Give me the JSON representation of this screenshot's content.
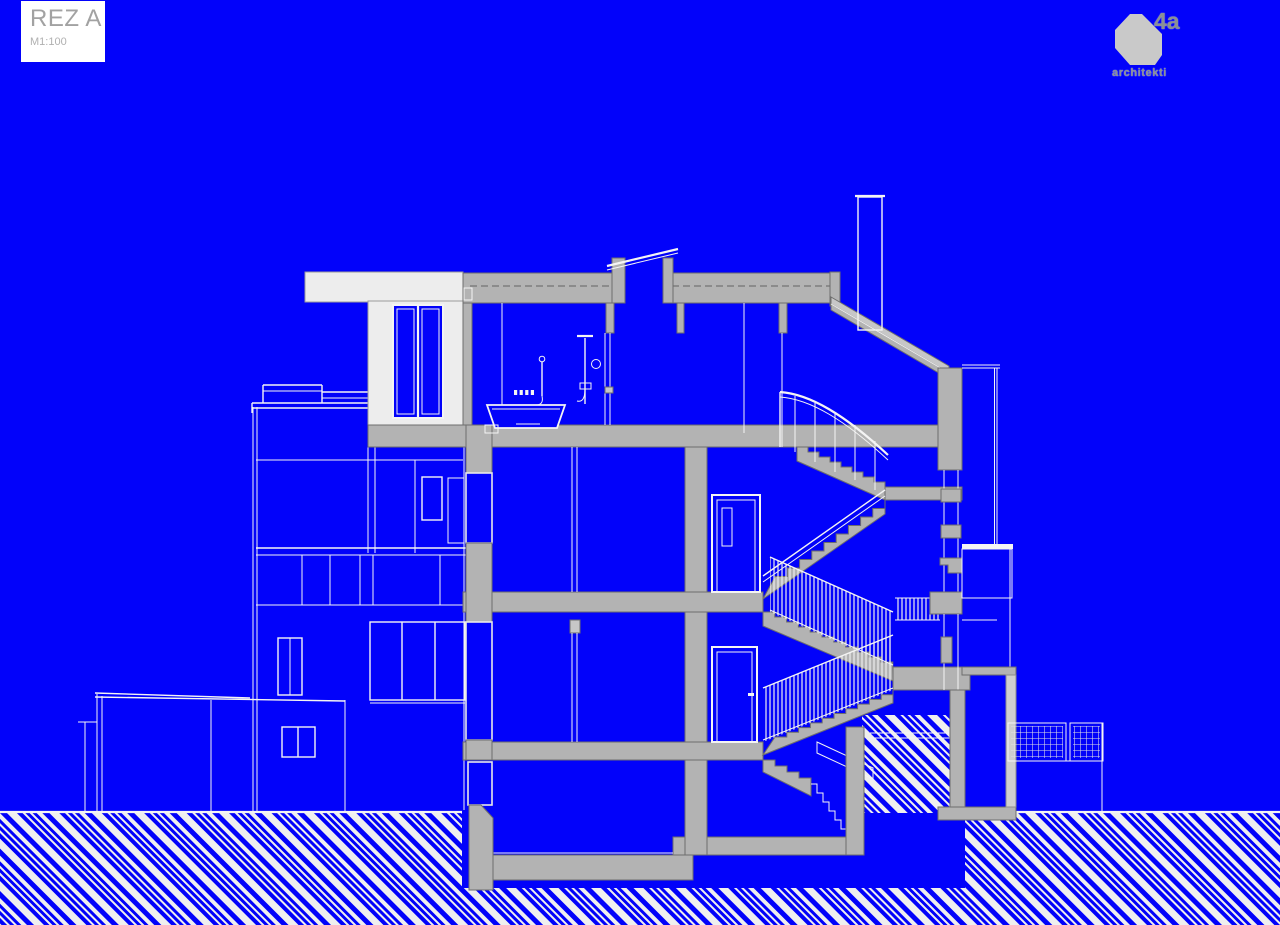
{
  "title_block": {
    "title": "REZ A",
    "scale": "M1:100"
  },
  "logo": {
    "mark": "4a",
    "name": "architekti"
  },
  "palette": {
    "background": "#0202fa",
    "cut_fill": "#b3b3b3",
    "cut_outline": "#6e6e6e",
    "line_white": "#f4f4f4",
    "elevation_white": "#ededed",
    "elevation_outline": "#9c9c9c",
    "title_bg": "#ffffff",
    "title_text": "#a2a2a2",
    "scale_text": "#b0b0b0",
    "logo_shape": "#c9c9c9",
    "logo_text": "#8a9094"
  },
  "drawing": {
    "kind": "building cross-section",
    "visible_elements": [
      "flat-roof-with-skylight",
      "chimney",
      "penthouse-volume",
      "terrace-railing",
      "bathroom-with-bathtub-and-showers",
      "four-storey-switchback-staircase",
      "hatched-stair-balustrades",
      "interior-doors",
      "left-facade-windows",
      "garden-annex-elevation",
      "right-terrace-with-grille-panels",
      "foundation-piers",
      "hatched-ground-band"
    ]
  }
}
